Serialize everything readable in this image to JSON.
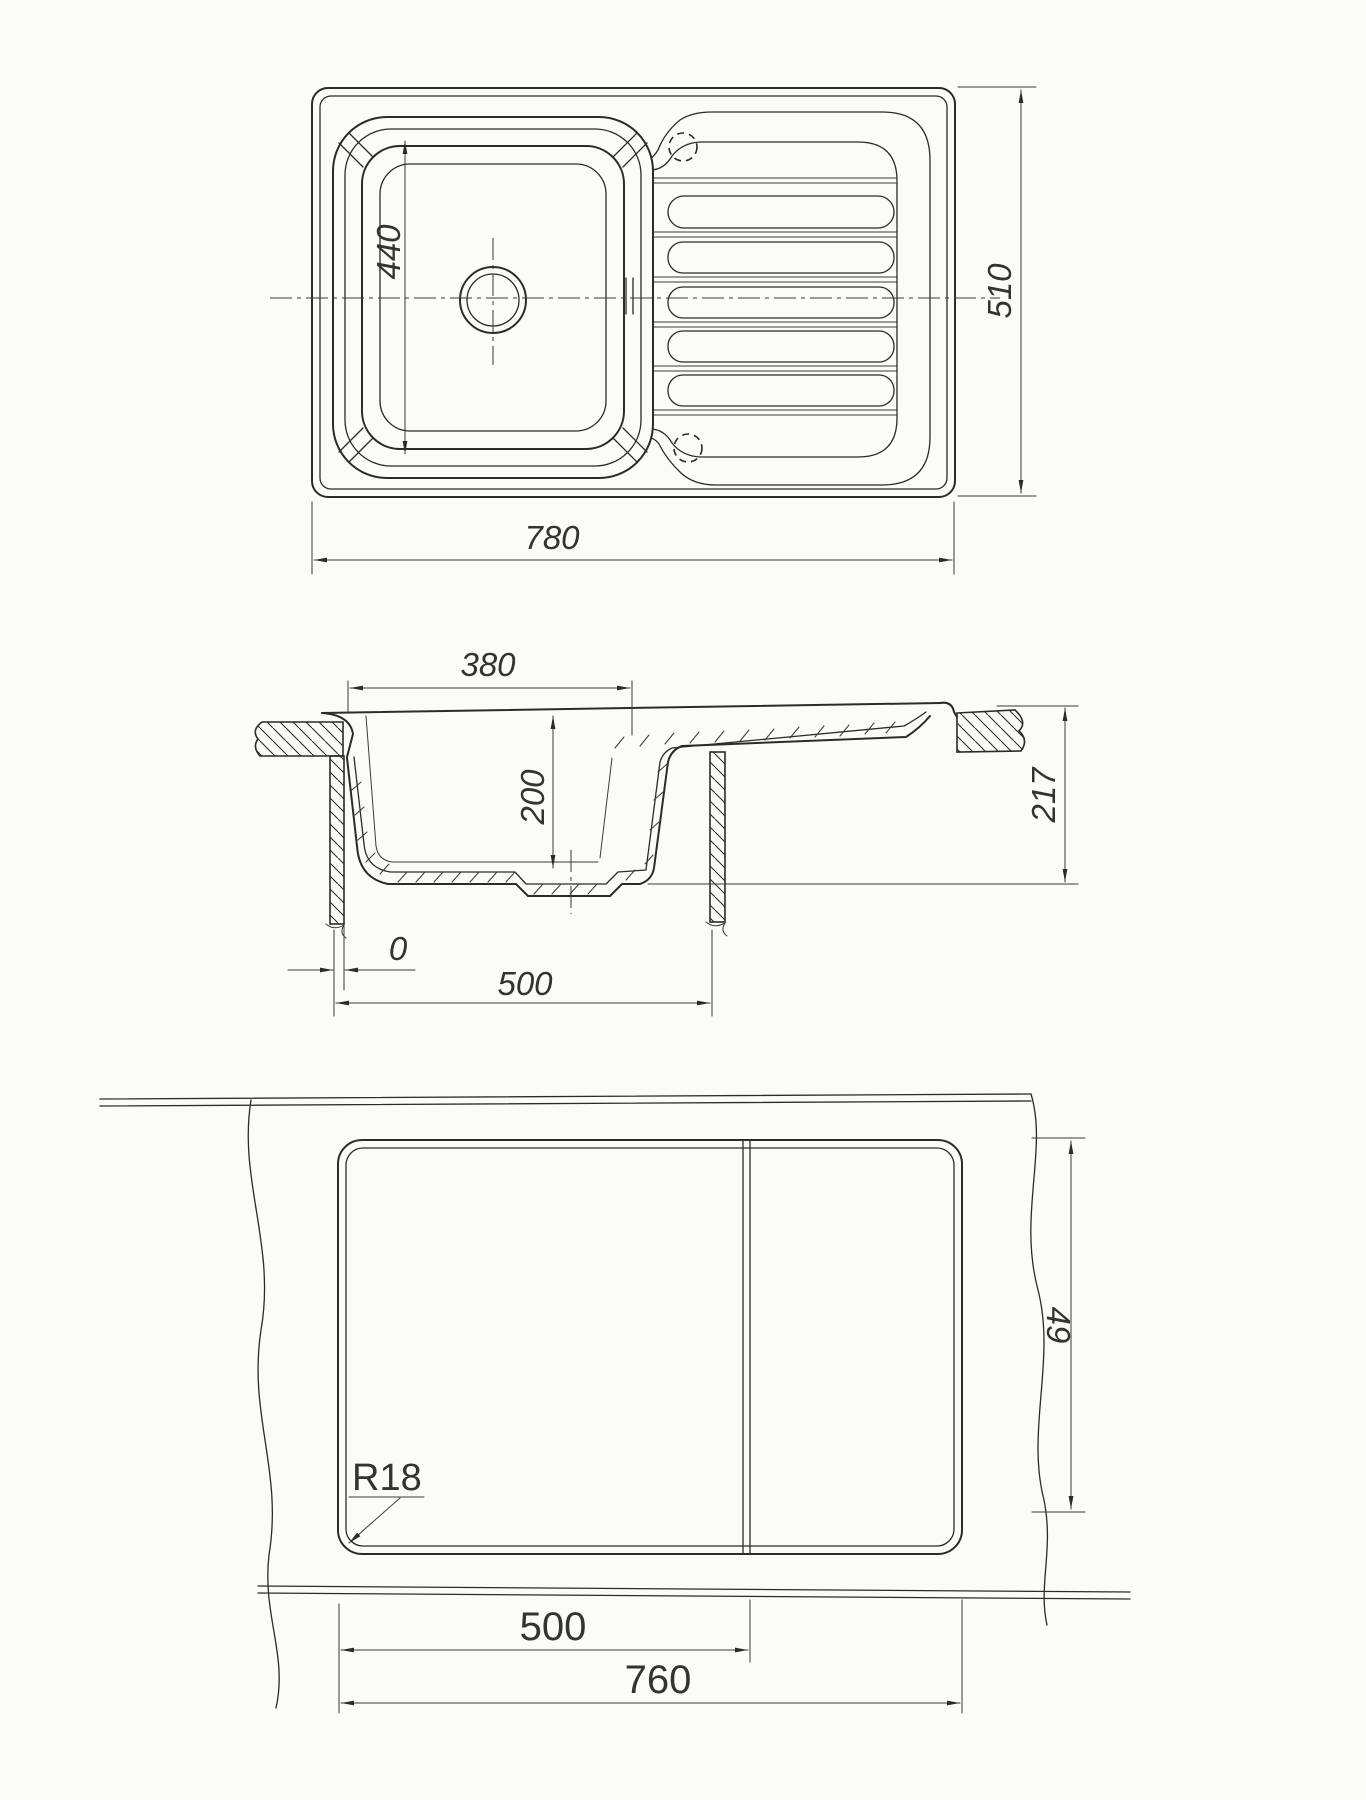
{
  "colors": {
    "paper": "#fbfbf8",
    "ink": "#2b2b2b",
    "dim_ink": "#3a3a3a"
  },
  "views": {
    "top_view": {
      "dims": {
        "bowl_inner_length": "440",
        "overall_width": "780",
        "overall_depth": "510"
      }
    },
    "section_view": {
      "dims": {
        "bowl_opening_width": "380",
        "bowl_depth": "200",
        "edge_offset": "0",
        "cabinet_opening_width": "500",
        "overall_height": "217"
      }
    },
    "cutout_view": {
      "dims": {
        "corner_radius": "R18",
        "bowl_cutout_width": "500",
        "total_cutout_width": "760",
        "drainer_cutout_depth": "49"
      }
    }
  }
}
